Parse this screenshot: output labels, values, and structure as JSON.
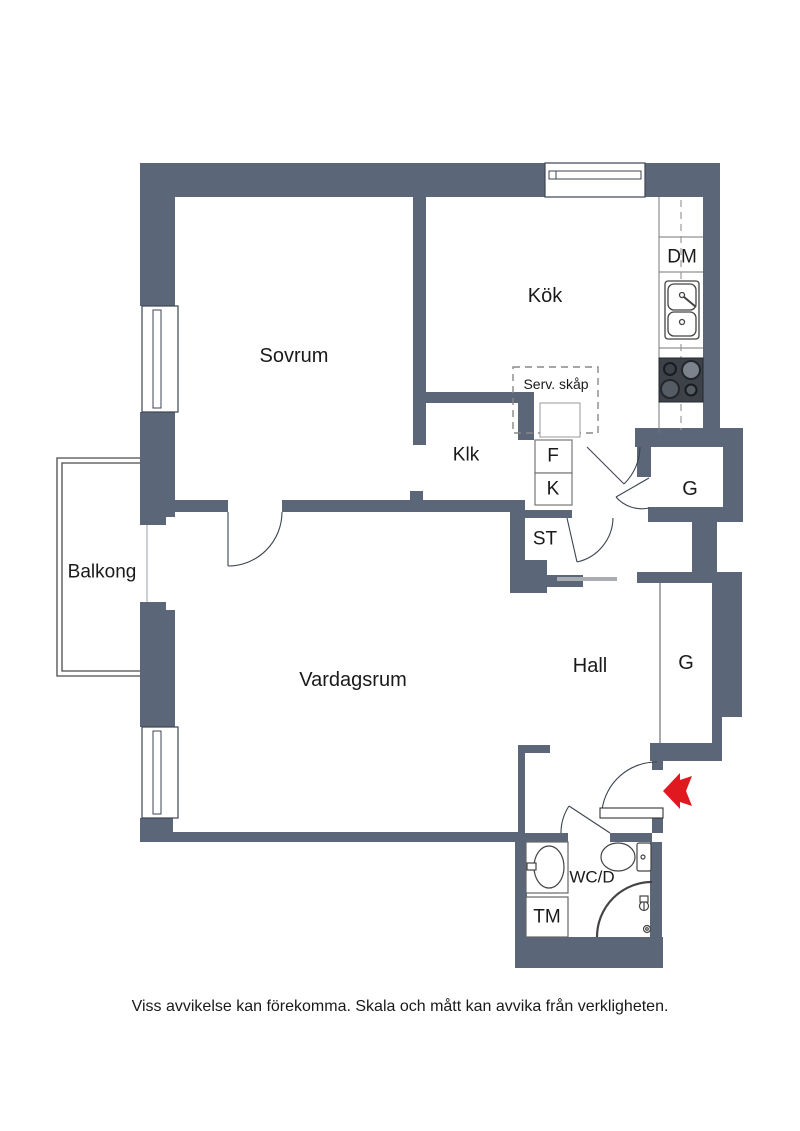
{
  "plan": {
    "rooms": {
      "sovrum": "Sovrum",
      "kok": "Kök",
      "klk": "Klk",
      "balkong": "Balkong",
      "vardagsrum": "Vardagsrum",
      "hall": "Hall",
      "wardrobe_upper": "G",
      "wardrobe_hall": "G",
      "fridge": "F",
      "freezer": "K",
      "stadskap": "ST",
      "dishwasher": "DM",
      "serv_skap": "Serv. skåp",
      "wc_dusch": "WC/D",
      "washer": "TM"
    },
    "disclaimer": "Viss avvikelse kan förekomma. Skala och mått kan avvika från verkligheten.",
    "colors": {
      "wall": "#5b6778",
      "arrow": "#e0181f",
      "line": "#3d4450"
    }
  }
}
